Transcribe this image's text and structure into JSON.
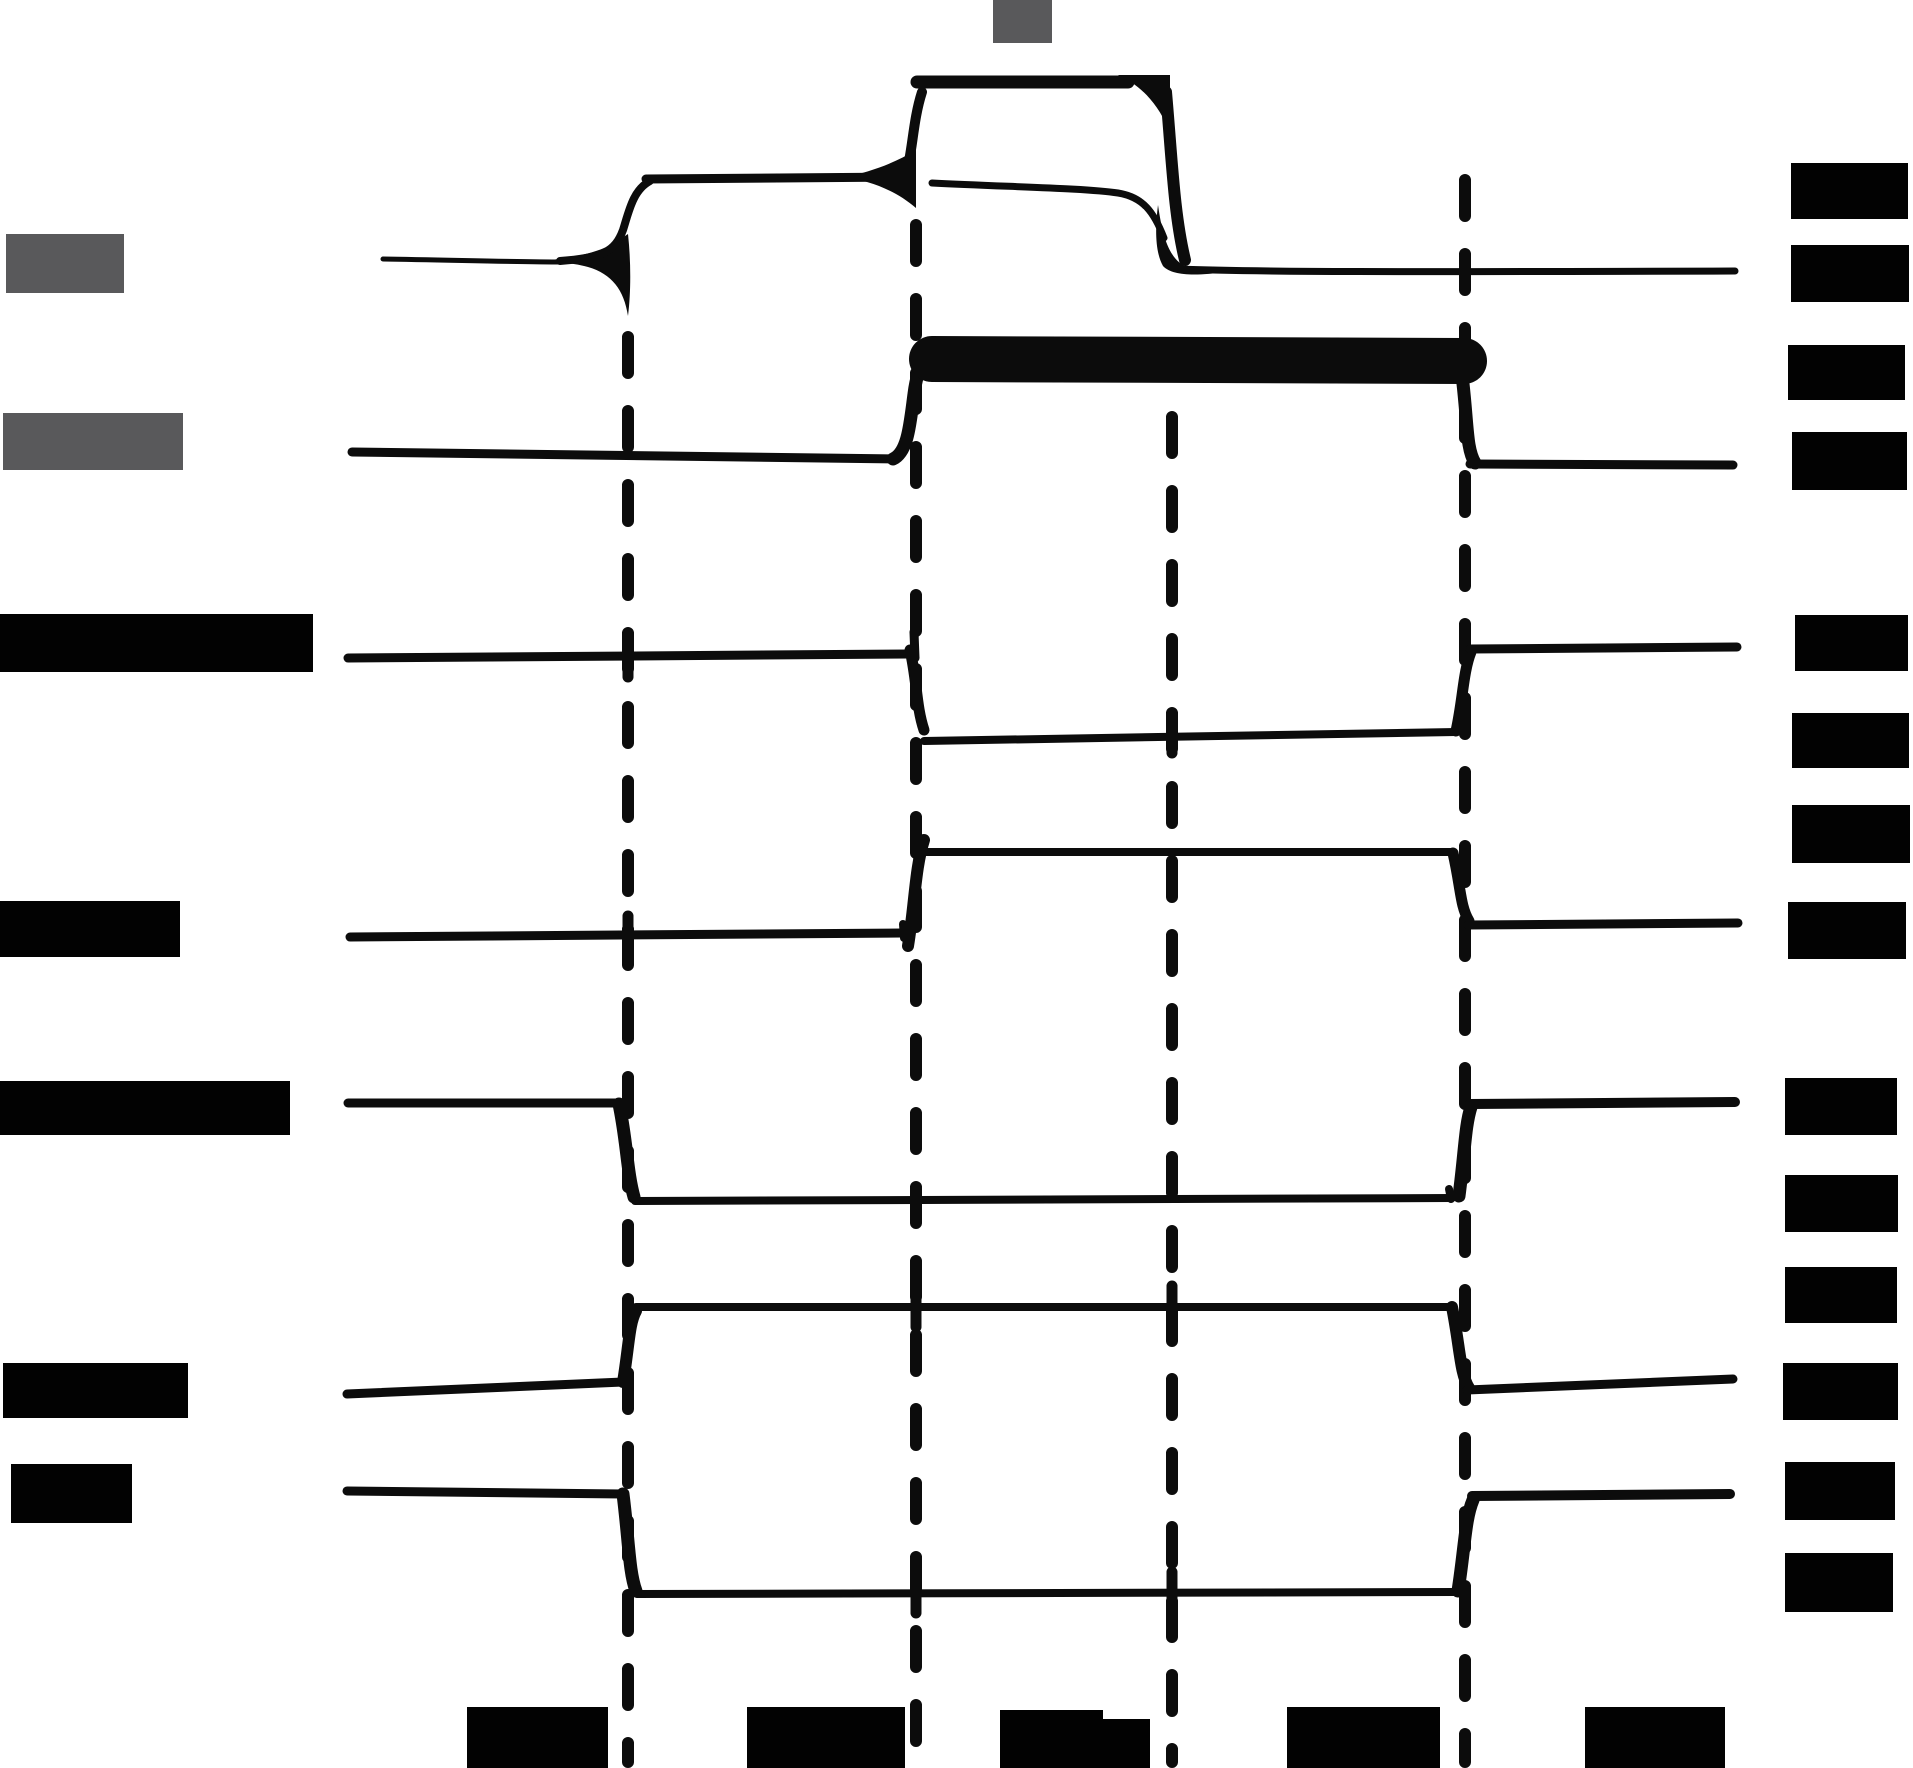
{
  "canvas": {
    "width": 1913,
    "height": 1768,
    "background": "#ffffff"
  },
  "colors": {
    "ink": "#0c0c0c",
    "redaction_black": "#020202",
    "redaction_gray": "#59595b"
  },
  "dash_style": {
    "stroke_width": 12,
    "dasharray": "36 38",
    "linecap": "round"
  },
  "dashed_lines": [
    {
      "name": "time-ref-line-1",
      "x": 628,
      "y1": 337,
      "y2": 1762
    },
    {
      "name": "time-ref-line-2",
      "x": 916,
      "y1": 225,
      "y2": 1762
    },
    {
      "name": "time-ref-line-3",
      "x": 1172,
      "y1": 417,
      "y2": 1762
    },
    {
      "name": "time-ref-line-4",
      "x": 1465,
      "y1": 180,
      "y2": 1762
    }
  ],
  "labels": {
    "top": [
      {
        "name": "top-annotation-redaction",
        "x": 993,
        "y": 0,
        "w": 59,
        "h": 43,
        "tone": "gray"
      }
    ],
    "left": [
      {
        "name": "signal-1-name-redaction",
        "x": 6,
        "y": 234,
        "w": 118,
        "h": 59,
        "tone": "gray"
      },
      {
        "name": "signal-2-name-redaction",
        "x": 3,
        "y": 413,
        "w": 180,
        "h": 57,
        "tone": "gray"
      },
      {
        "name": "signal-3-name-redaction",
        "x": 0,
        "y": 614,
        "w": 313,
        "h": 58,
        "tone": "black"
      },
      {
        "name": "signal-4-name-redaction",
        "x": 0,
        "y": 901,
        "w": 180,
        "h": 56,
        "tone": "black"
      },
      {
        "name": "signal-5-name-redaction",
        "x": 0,
        "y": 1081,
        "w": 290,
        "h": 54,
        "tone": "black"
      },
      {
        "name": "signal-6-name-redaction",
        "x": 3,
        "y": 1363,
        "w": 185,
        "h": 55,
        "tone": "black"
      },
      {
        "name": "signal-7-name-redaction",
        "x": 11,
        "y": 1464,
        "w": 121,
        "h": 59,
        "tone": "black"
      }
    ],
    "right": [
      {
        "name": "level-annotation-1-redaction",
        "x": 1791,
        "y": 163,
        "w": 117,
        "h": 56,
        "tone": "black"
      },
      {
        "name": "level-annotation-2-redaction",
        "x": 1791,
        "y": 245,
        "w": 118,
        "h": 57,
        "tone": "black"
      },
      {
        "name": "level-annotation-3-redaction",
        "x": 1788,
        "y": 345,
        "w": 117,
        "h": 55,
        "tone": "black"
      },
      {
        "name": "level-annotation-4-redaction",
        "x": 1792,
        "y": 432,
        "w": 115,
        "h": 58,
        "tone": "black"
      },
      {
        "name": "level-annotation-5-redaction",
        "x": 1795,
        "y": 615,
        "w": 113,
        "h": 56,
        "tone": "black"
      },
      {
        "name": "level-annotation-6-redaction",
        "x": 1792,
        "y": 713,
        "w": 117,
        "h": 55,
        "tone": "black"
      },
      {
        "name": "level-annotation-7-redaction",
        "x": 1792,
        "y": 805,
        "w": 118,
        "h": 58,
        "tone": "black"
      },
      {
        "name": "level-annotation-8-redaction",
        "x": 1788,
        "y": 902,
        "w": 118,
        "h": 57,
        "tone": "black"
      },
      {
        "name": "level-annotation-9-redaction",
        "x": 1785,
        "y": 1078,
        "w": 112,
        "h": 57,
        "tone": "black"
      },
      {
        "name": "level-annotation-10-redaction",
        "x": 1785,
        "y": 1175,
        "w": 113,
        "h": 57,
        "tone": "black"
      },
      {
        "name": "level-annotation-11-redaction",
        "x": 1785,
        "y": 1267,
        "w": 112,
        "h": 56,
        "tone": "black"
      },
      {
        "name": "level-annotation-12-redaction",
        "x": 1783,
        "y": 1363,
        "w": 115,
        "h": 57,
        "tone": "black"
      },
      {
        "name": "level-annotation-13-redaction",
        "x": 1785,
        "y": 1462,
        "w": 110,
        "h": 58,
        "tone": "black"
      },
      {
        "name": "level-annotation-14-redaction",
        "x": 1785,
        "y": 1553,
        "w": 108,
        "h": 59,
        "tone": "black"
      }
    ],
    "bottom": [
      {
        "name": "time-interval-1-redaction",
        "x": 467,
        "y": 1707,
        "w": 141,
        "h": 61,
        "tone": "black"
      },
      {
        "name": "time-interval-2-redaction",
        "x": 747,
        "y": 1707,
        "w": 158,
        "h": 61,
        "tone": "black"
      },
      {
        "name": "time-interval-3-redaction",
        "x": 1000,
        "y": 1710,
        "w": 103,
        "h": 58,
        "tone": "black"
      },
      {
        "name": "time-interval-3-subscript-redaction",
        "x": 1103,
        "y": 1719,
        "w": 47,
        "h": 49,
        "tone": "black"
      },
      {
        "name": "time-interval-4-redaction",
        "x": 1287,
        "y": 1707,
        "w": 153,
        "h": 61,
        "tone": "black"
      },
      {
        "name": "time-interval-5-redaction",
        "x": 1585,
        "y": 1707,
        "w": 140,
        "h": 61,
        "tone": "black"
      }
    ]
  },
  "traces": [
    {
      "name": "trace-1",
      "logic": "low, rises to mid at ref-1, rises to high at ref-2 (mid line also held), falls to low at ref-3",
      "segments": [
        {
          "kind": "stroke",
          "d": "M383 259 C450 260 520 262 562 262",
          "w": 5
        },
        {
          "kind": "fill",
          "d": "M540 261 C575 258 600 252 616 242 L628 234 C631 262 631 292 628 316 C624 290 612 274 588 267 C570 262 552 262 540 261 Z"
        },
        {
          "kind": "stroke",
          "d": "M560 261 C602 258 615 252 623 230 C629 211 633 190 650 181",
          "w": 8
        },
        {
          "kind": "stroke",
          "d": "M646 179 L908 177",
          "w": 9
        },
        {
          "kind": "fill",
          "d": "M845 177 C870 172 895 163 916 150 L916 208 C895 190 870 181 845 177 Z"
        },
        {
          "kind": "stroke",
          "d": "M906 176 C913 148 913 120 922 92",
          "w": 10
        },
        {
          "kind": "stroke",
          "d": "M917 82 L1128 82",
          "w": 13
        },
        {
          "kind": "fill",
          "d": "M1118 75 L1170 75 L1170 132 C1158 104 1142 86 1118 75 Z"
        },
        {
          "kind": "stroke",
          "d": "M932 183 C1010 187 1085 188 1118 193 C1143 197 1154 212 1164 238",
          "w": 7
        },
        {
          "kind": "stroke",
          "d": "M1166 92 C1172 160 1174 215 1185 260",
          "w": 12
        },
        {
          "kind": "fill",
          "d": "M1158 205 C1163 240 1170 260 1188 268 L1225 272 C1196 276 1172 276 1163 266 C1155 252 1155 228 1158 205 Z"
        },
        {
          "kind": "stroke",
          "d": "M1180 269 C1250 272 1400 272 1735 271",
          "w": 7
        }
      ],
      "ticks": []
    },
    {
      "name": "trace-2",
      "logic": "low, rises to thick high band at ref-2, falls to low at ref-4",
      "segments": [
        {
          "kind": "stroke",
          "d": "M352 452 L895 459",
          "w": 9
        },
        {
          "kind": "stroke",
          "d": "M893 459 C908 452 910 424 914 394 C917 370 923 358 934 353",
          "w": 13
        },
        {
          "kind": "stroke",
          "d": "M932 359 L1464 361",
          "w": 46
        },
        {
          "kind": "stroke",
          "d": "M1462 375 C1468 424 1466 448 1475 463",
          "w": 13
        },
        {
          "kind": "stroke",
          "d": "M1470 464 L1733 465",
          "w": 9
        }
      ],
      "ticks": []
    },
    {
      "name": "trace-3",
      "logic": "high, falls to low at ref-2, rises to high at ref-4",
      "segments": [
        {
          "kind": "stroke",
          "d": "M348 658 L908 654",
          "w": 9
        },
        {
          "kind": "stroke",
          "d": "M914 632 L915 658",
          "w": 9
        },
        {
          "kind": "stroke",
          "d": "M910 650 C917 680 916 706 924 730",
          "w": 11
        },
        {
          "kind": "stroke",
          "d": "M924 741 L1456 732",
          "w": 8
        },
        {
          "kind": "stroke",
          "d": "M1456 731 C1463 700 1463 672 1471 652",
          "w": 11
        },
        {
          "kind": "stroke",
          "d": "M1470 649 L1737 647",
          "w": 9
        }
      ],
      "ticks": [
        {
          "x": 628,
          "y": 657
        },
        {
          "x": 1172,
          "y": 733
        }
      ]
    },
    {
      "name": "trace-4",
      "logic": "low, rises to high at ref-2, falls to low at ref-4",
      "segments": [
        {
          "kind": "stroke",
          "d": "M350 937 L902 933",
          "w": 9
        },
        {
          "kind": "stroke",
          "d": "M903 924 L904 938",
          "w": 8
        },
        {
          "kind": "stroke",
          "d": "M908 946 C915 903 915 868 924 840",
          "w": 12
        },
        {
          "kind": "stroke",
          "d": "M925 852 L1453 852",
          "w": 8
        },
        {
          "kind": "stroke",
          "d": "M1453 853 C1461 888 1460 906 1469 921",
          "w": 11
        },
        {
          "kind": "stroke",
          "d": "M1468 925 L1738 923",
          "w": 9
        }
      ],
      "ticks": [
        {
          "x": 628,
          "y": 936
        }
      ]
    },
    {
      "name": "trace-5",
      "logic": "high, falls to low at ref-1, rises to high at ref-4",
      "segments": [
        {
          "kind": "stroke",
          "d": "M348 1103 L619 1103",
          "w": 9
        },
        {
          "kind": "stroke",
          "d": "M619 1104 C627 1142 627 1172 634 1197",
          "w": 13
        },
        {
          "kind": "stroke",
          "d": "M635 1201 L1452 1198",
          "w": 8
        },
        {
          "kind": "stroke",
          "d": "M1449 1189 L1451 1199",
          "w": 8
        },
        {
          "kind": "stroke",
          "d": "M1459 1196 C1465 1150 1465 1126 1471 1107",
          "w": 13
        },
        {
          "kind": "stroke",
          "d": "M1470 1104 L1735 1102",
          "w": 10
        }
      ],
      "ticks": []
    },
    {
      "name": "trace-6",
      "logic": "low, rises to high at ref-1, falls to low at ref-4",
      "segments": [
        {
          "kind": "stroke",
          "d": "M347 1394 L623 1382",
          "w": 9
        },
        {
          "kind": "stroke",
          "d": "M623 1382 C629 1346 629 1323 636 1311",
          "w": 12
        },
        {
          "kind": "stroke",
          "d": "M636 1307 L1452 1307",
          "w": 8
        },
        {
          "kind": "stroke",
          "d": "M1452 1307 C1460 1347 1460 1374 1469 1388",
          "w": 12
        },
        {
          "kind": "stroke",
          "d": "M1467 1390 L1733 1379",
          "w": 9
        }
      ],
      "ticks": [
        {
          "x": 916,
          "y": 1307
        },
        {
          "x": 1172,
          "y": 1306
        }
      ]
    },
    {
      "name": "trace-7",
      "logic": "high, falls to low at ref-1, rises to high at ref-4",
      "segments": [
        {
          "kind": "stroke",
          "d": "M347 1491 L623 1494",
          "w": 9
        },
        {
          "kind": "stroke",
          "d": "M623 1494 C629 1542 629 1572 636 1591",
          "w": 13
        },
        {
          "kind": "stroke",
          "d": "M637 1594 L1456 1592",
          "w": 8
        },
        {
          "kind": "stroke",
          "d": "M1458 1591 C1465 1546 1465 1519 1473 1500",
          "w": 13
        },
        {
          "kind": "stroke",
          "d": "M1472 1496 L1730 1494",
          "w": 10
        }
      ],
      "ticks": [
        {
          "x": 916,
          "y": 1593
        },
        {
          "x": 1172,
          "y": 1592
        }
      ]
    }
  ],
  "tick_style": {
    "width": 11,
    "half_length": 20
  }
}
